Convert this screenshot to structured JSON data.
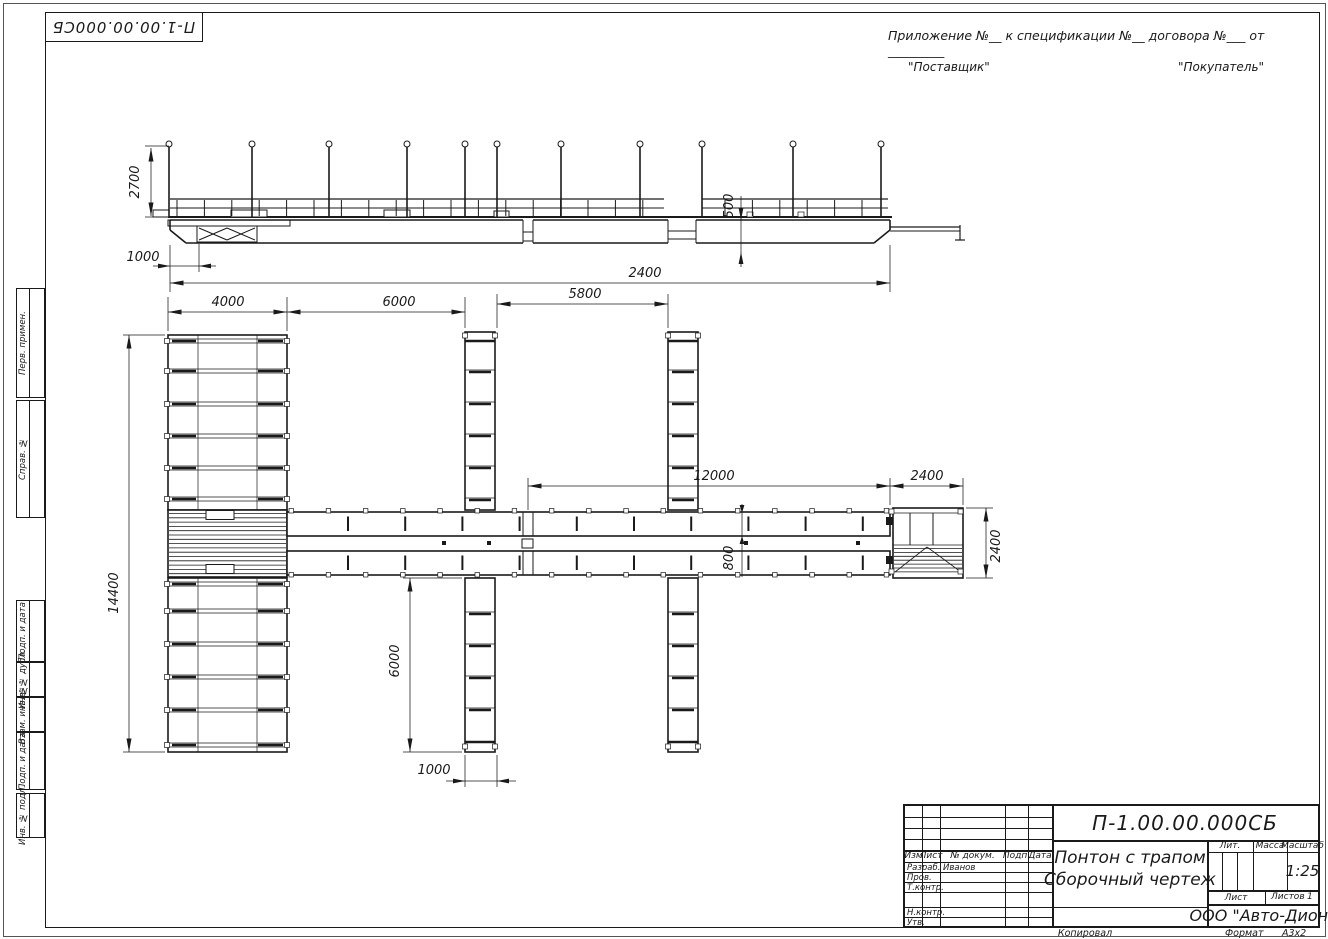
{
  "doc": {
    "number": "П-1.00.00.000СБ"
  },
  "header": {
    "appendix_line": "Приложение №__    к спецификации №__   договора №___ от _________",
    "supplier": "\"Поставщик\"",
    "buyer": "\"Покупатель\""
  },
  "frame_stamps": {
    "items": [
      {
        "label": "Перв. примен."
      },
      {
        "label": "Справ. №"
      },
      {
        "label": "Подп. и дата"
      },
      {
        "label": "Инв. № дубл."
      },
      {
        "label": "Взам. инв. №"
      },
      {
        "label": "Подп. и дата"
      },
      {
        "label": "Инв. № подл."
      }
    ]
  },
  "dims": {
    "side": {
      "post_height": "2700",
      "ramp_offset": "1000",
      "freeboard": "500",
      "total_length": "2400"
    },
    "plan": {
      "pier_width": "4000",
      "gap1": "6000",
      "gap2": "5800",
      "walkway": "12000",
      "platform_length": "2400",
      "walkway_width": "800",
      "platform_width": "2400",
      "pier_length": "14400",
      "finger_length": "6000",
      "finger_width": "1000"
    }
  },
  "title_block": {
    "doc_number": "П-1.00.00.000СБ",
    "name_line1": "Понтон с трапом",
    "name_line2": "Сборочный чертеж",
    "columns": [
      {
        "label": "Изм"
      },
      {
        "label": "Лист"
      },
      {
        "label": "№ докум."
      },
      {
        "label": "Подп."
      },
      {
        "label": "Дата"
      }
    ],
    "rows": [
      {
        "label": "Разраб.",
        "value": "Иванов"
      },
      {
        "label": "Пров.",
        "value": ""
      },
      {
        "label": "Т.контр.",
        "value": ""
      },
      {
        "label": "Н.контр.",
        "value": ""
      },
      {
        "label": "Утв.",
        "value": ""
      }
    ],
    "lit_label": "Лит.",
    "mass_label": "Масса",
    "scale_label": "Масштаб",
    "scale_value": "1:25",
    "sheet_label": "Лист",
    "sheets_label": "Листов",
    "sheets_value": "1",
    "company": "ООО \"Авто-Дион\""
  },
  "footer": {
    "copied": "Копировал",
    "format_label": "Формат",
    "format_value": "А3х2"
  }
}
